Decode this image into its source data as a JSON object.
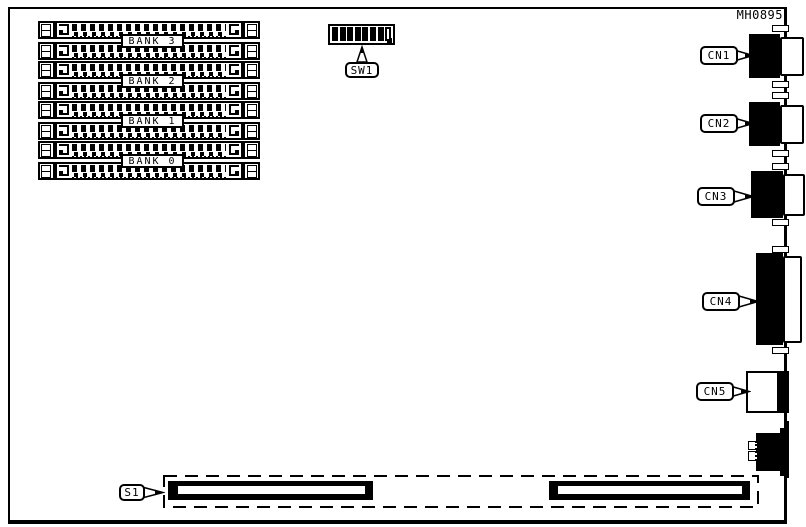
{
  "doc_code": "MH0895",
  "banks": [
    {
      "label": "BANK 3"
    },
    {
      "label": "BANK 2"
    },
    {
      "label": "BANK 1"
    },
    {
      "label": "BANK 0"
    }
  ],
  "dip_switch": {
    "label": "SW1",
    "positions": [
      1,
      1,
      1,
      1,
      1,
      1,
      1,
      0
    ]
  },
  "connectors": [
    {
      "label": "CN1"
    },
    {
      "label": "CN2"
    },
    {
      "label": "CN3"
    },
    {
      "label": "CN4"
    },
    {
      "label": "CN5"
    }
  ],
  "edge_slot": {
    "label": "S1"
  },
  "colors": {
    "line": "#000000",
    "background": "#ffffff"
  }
}
